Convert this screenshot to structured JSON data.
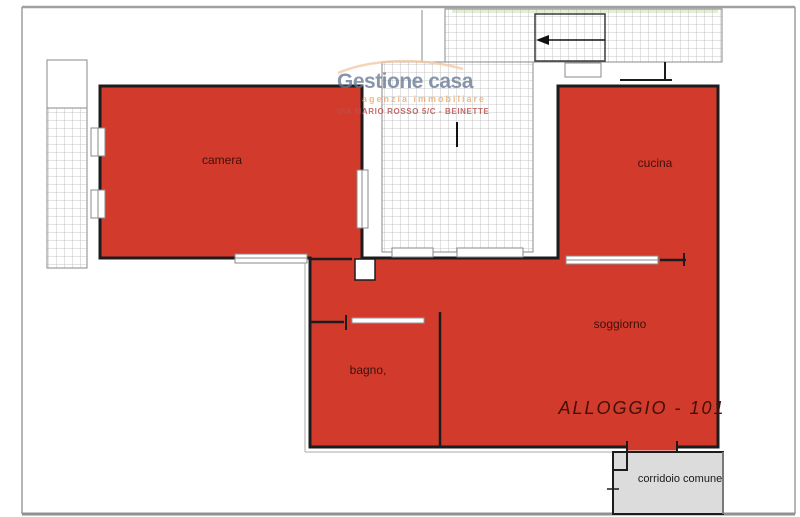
{
  "watermark": {
    "brand": "Gestione casa",
    "tagline": "agenzia immobiliare",
    "address": "VIA MARIO ROSSO 5/C - BEINETTE"
  },
  "plan": {
    "unit_label": "ALLOGGIO - 101",
    "rooms": {
      "camera": "camera",
      "cucina": "cucina",
      "soggiorno": "soggiorno",
      "bagno": "bagno,",
      "corridor": "corridoio comune"
    }
  },
  "icons": {
    "entry_direction_arrow": "left-arrow"
  },
  "colors": {
    "apartment_fill": "#d23a2c",
    "room_label": "#40100a",
    "corridor_fill": "#dcdcdc",
    "corridor_label": "#1a1a1a",
    "wall": "#1c1c1c",
    "hatch_line": "#b8b8b8",
    "border_gray": "#9e9e9e",
    "brand_blue": "#657796",
    "tagline_orange": "#e89440",
    "address_red": "#ba5250"
  }
}
